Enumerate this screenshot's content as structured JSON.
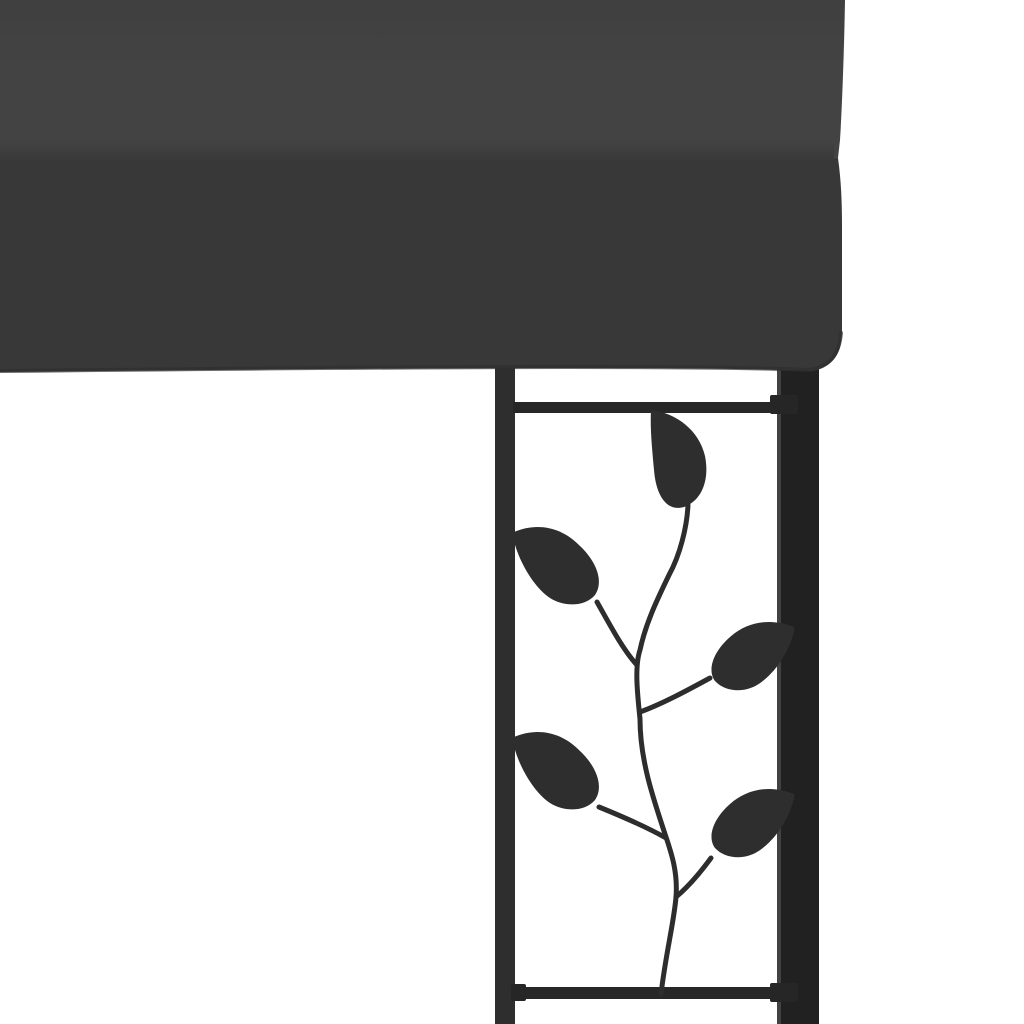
{
  "image": {
    "type": "product-photo",
    "alt": "Close-up corner of an anthracite wall gazebo: dark grey fabric canopy resting on a black steel post with a decorative leaf-vine trellis panel on a white background",
    "background_color": "#ffffff"
  },
  "canopy": {
    "roof_color": "#434343",
    "valance_color": "#383838",
    "edge_shadow_color": "#2e2f2f"
  },
  "frame": {
    "post_color": "#212121",
    "post_highlight_color": "#4d4d4d",
    "left_bar_color": "#2e2e2e",
    "rail_color": "#272727",
    "cap_color": "#262626"
  },
  "vine": {
    "stem_color": "#2d2d2d",
    "leaf_color": "#2e2e2e",
    "leaf_count": 5
  }
}
